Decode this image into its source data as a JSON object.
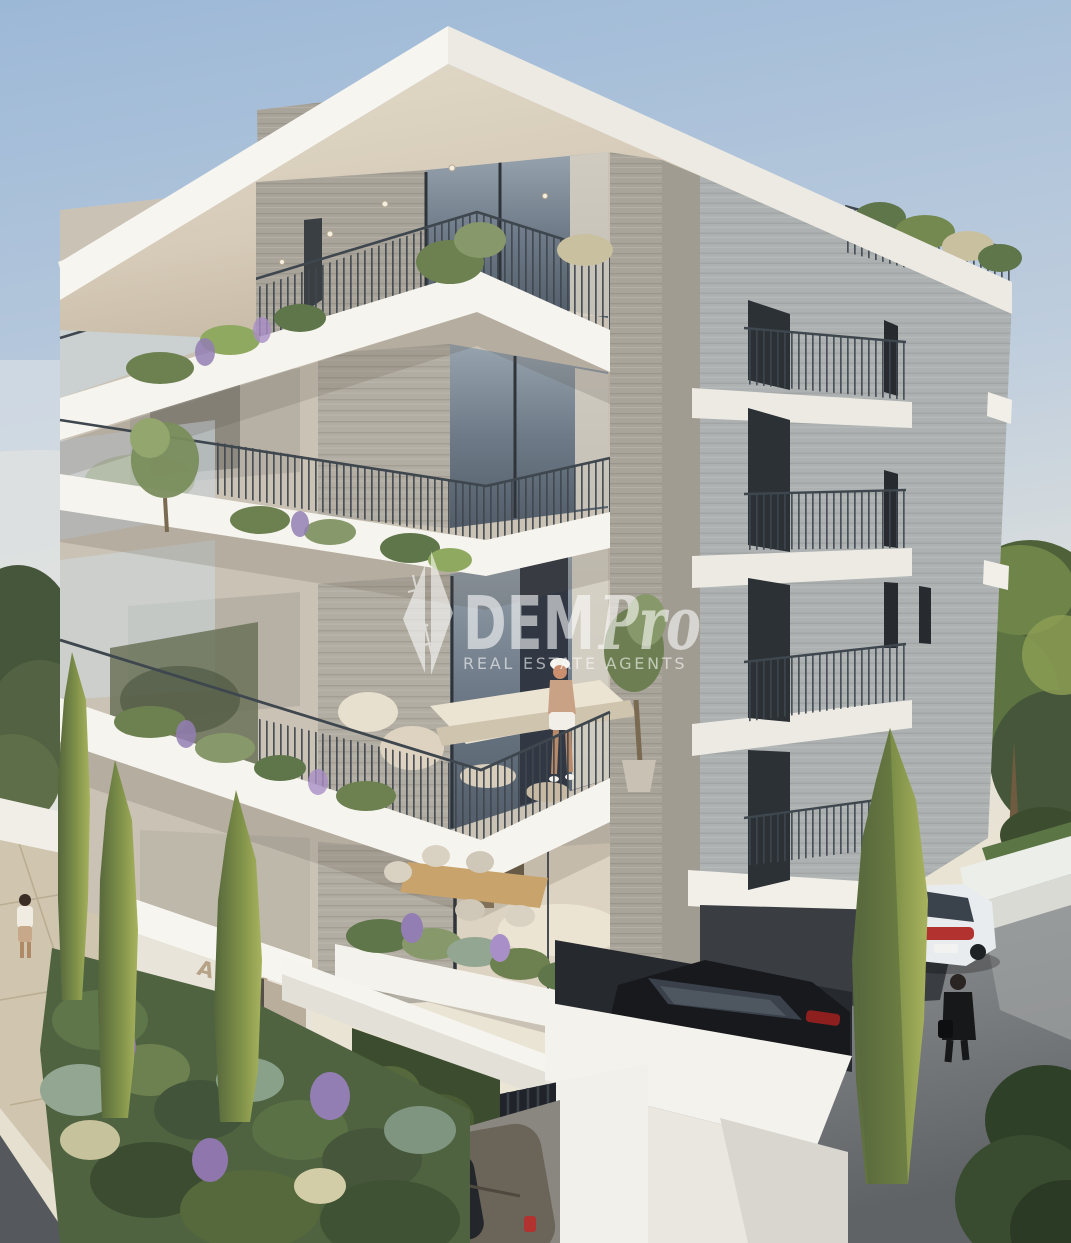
{
  "watermark": {
    "logo_icon": "dempro-diamond-logo",
    "brand_bold": "DEM",
    "brand_italic": "Pro",
    "tagline": "REAL ESTATE AGENTS",
    "color": "#ffffff"
  },
  "signage": {
    "building_name": "ARIA",
    "color": "#b5a287"
  },
  "scene": {
    "setting": "modern apartment building exterior 3d render, corner view",
    "balcony_levels": 4,
    "people_visible": 3,
    "vehicles_visible": 3
  },
  "palette": {
    "sky_top": "#9cb8d7",
    "sky_mid": "#c6d2df",
    "sky_horizon": "#e9e3d3",
    "slab_white": "#f6f4ee",
    "soffit_beige": "#d6cbb8",
    "concrete_warm": "#b2ada2",
    "concrete_cool": "#b4b7b5",
    "railing": "#3e464e",
    "glass": "#76828e",
    "foliage_dark": "#46563a",
    "foliage_light": "#7e9456",
    "lavender": "#937eb4",
    "cypress": "#8b9b54",
    "asphalt": "#84878a",
    "paving": "#d0c5ae",
    "car_black": "#1a1d21",
    "car_white": "#e9ecee",
    "car_suv": "#6b6459",
    "taillight_red": "#b23230"
  }
}
